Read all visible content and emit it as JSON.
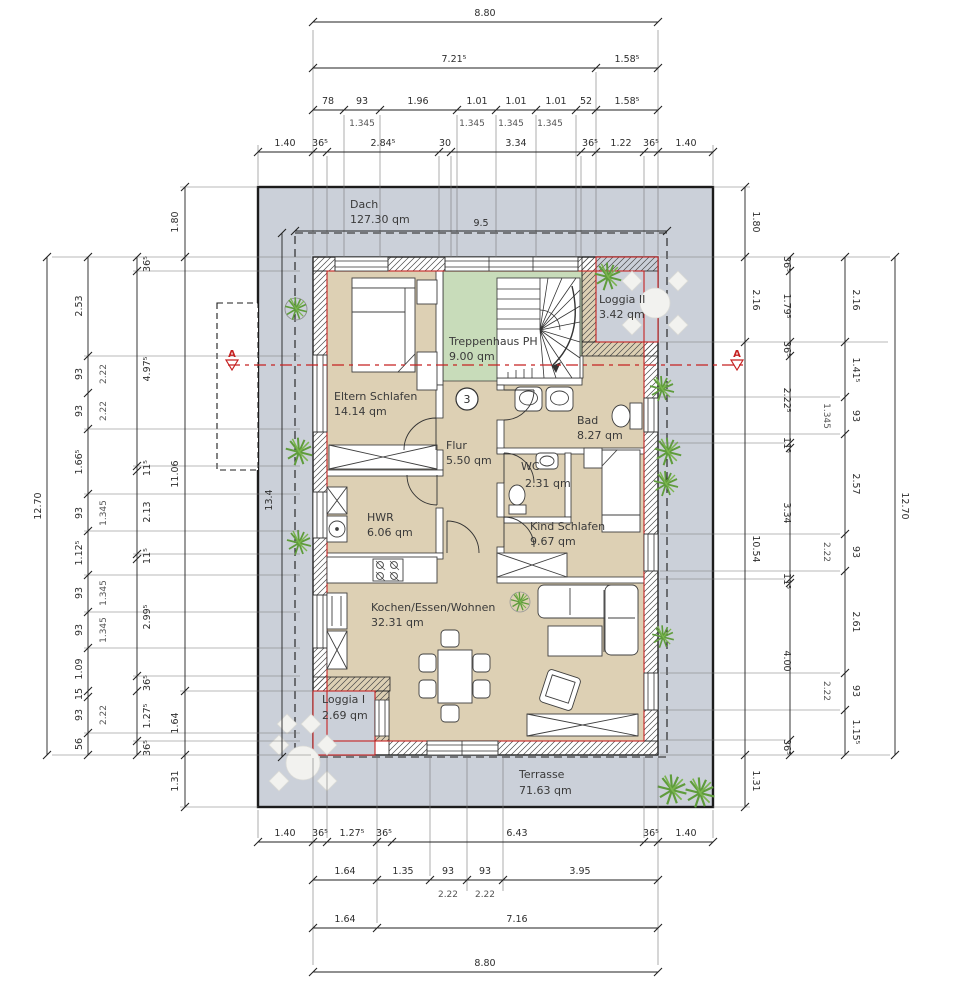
{
  "labels": {
    "dach_name": "Dach",
    "dach_area": "127.30 qm",
    "terrasse_name": "Terrasse",
    "terrasse_area": "71.63 qm",
    "envelope_width": "9.5",
    "envelope_depth": "13.4",
    "section_letter": "A",
    "storey_number": "3"
  },
  "rooms": {
    "treppenhaus": {
      "name": "Treppenhaus PH",
      "area": "9.00 qm"
    },
    "loggia2": {
      "name": "Loggia II",
      "area": "3.42 qm"
    },
    "eltern": {
      "name": "Eltern Schlafen",
      "area": "14.14 qm"
    },
    "bad": {
      "name": "Bad",
      "area": "8.27 qm"
    },
    "flur": {
      "name": "Flur",
      "area": "5.50 qm"
    },
    "wc": {
      "name": "WC",
      "area": "2.31 qm"
    },
    "hwr": {
      "name": "HWR",
      "area": "6.06 qm"
    },
    "kind": {
      "name": "Kind Schlafen",
      "area": "9.67 qm"
    },
    "wohnen": {
      "name": "Kochen/Essen/Wohnen",
      "area": "32.31 qm"
    },
    "loggia1": {
      "name": "Loggia I",
      "area": "2.69 qm"
    }
  },
  "dims": {
    "top1": "8.80",
    "top2": [
      "7.21⁵",
      "1.58⁵"
    ],
    "top3": [
      "78",
      "93",
      "1.96",
      "1.01",
      "1.01",
      "1.01",
      "52",
      "1.58⁵"
    ],
    "top3s": [
      "1.345",
      "1.345",
      "1.345",
      "1.345"
    ],
    "top4": [
      "1.40",
      "36⁵",
      "2.84⁵",
      "30",
      "3.34",
      "36⁵",
      "1.22",
      "36⁵",
      "1.40"
    ],
    "bot1": [
      "1.40",
      "36⁵",
      "1.27⁵",
      "36⁵",
      "6.43",
      "36⁵",
      "1.40"
    ],
    "bot2": [
      "1.64",
      "1.35",
      "93",
      "93",
      "3.95"
    ],
    "bot2s": [
      "2.22",
      "2.22"
    ],
    "bot3": [
      "1.64",
      "7.16"
    ],
    "bot4": "8.80",
    "l1": "12.70",
    "l2": [
      "2.53",
      "93",
      "93",
      "1.66⁵",
      "93",
      "1.12⁵",
      "93",
      "93",
      "1.09",
      "15",
      "93",
      "56"
    ],
    "l2s": [
      "2.22",
      "2.22",
      "1.345",
      "1.345",
      "1.345",
      "2.22"
    ],
    "l3": [
      "36⁵",
      "4.97⁵",
      "11⁵",
      "2.13",
      "11⁵",
      "2.99⁵",
      "36⁵",
      "1.27⁵",
      "36⁵"
    ],
    "l4": [
      "1.80",
      "11.06",
      "1.64",
      "1.31"
    ],
    "r1": [
      "1.80",
      "2.16",
      "10.54",
      "1.31"
    ],
    "r2": [
      "36⁵",
      "1.79⁵",
      "36⁵",
      "2.22⁵",
      "11⁵",
      "3.34",
      "11⁵",
      "4.00",
      "36⁵"
    ],
    "r3": [
      "2.16",
      "1.41⁵",
      "93",
      "2.57",
      "93",
      "2.61",
      "93",
      "1.15⁵"
    ],
    "r3s": [
      "1.345",
      "2.22",
      "2.22"
    ],
    "r4": "12.70"
  },
  "colors": {
    "site": "#cbd0d9",
    "room": "#ddd0b4",
    "stair": "#c8dcba",
    "accent_red": "#c52222",
    "plant_green": "#5f9c3c"
  }
}
